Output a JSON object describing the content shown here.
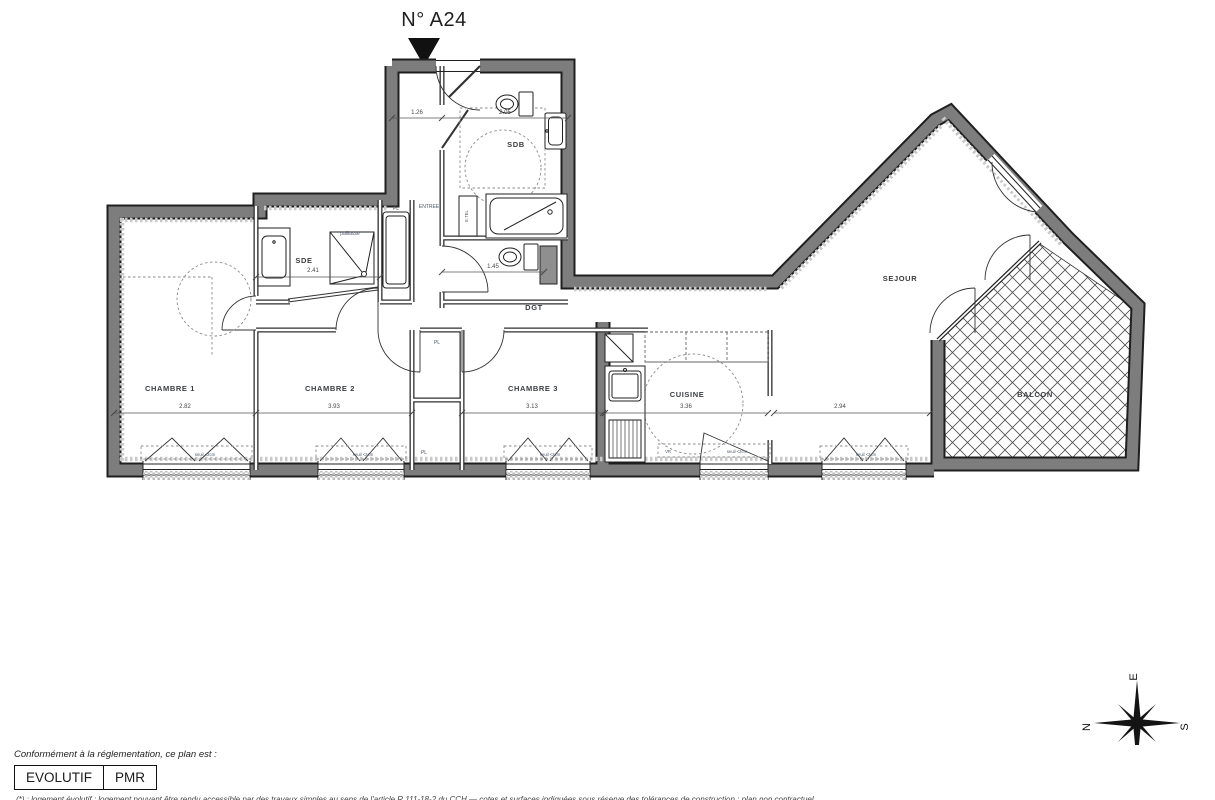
{
  "title": "N° A24",
  "plan": {
    "rooms": {
      "entree": "ENTREE",
      "sdb": "SDB",
      "sde": "SDE",
      "dgt": "DGT",
      "ch1": "CHAMBRE 1",
      "ch2": "CHAMBRE 2",
      "ch3": "CHAMBRE 3",
      "cuisine": "CUISINE",
      "sejour": "SEJOUR",
      "balcon": "BALCON"
    },
    "closets": {
      "pl1": "PL",
      "pl2": "PL",
      "pl3": "PL"
    },
    "annotations": {
      "paillasse": "paillasse",
      "etel": "E.TEL",
      "vr": "VR",
      "seuil": "seuil <2cm"
    },
    "dims": {
      "entree": "1.26",
      "sdb": "2.05",
      "sde": "2.41",
      "wc": "1.45",
      "ch1": "2.82",
      "ch2": "3.93",
      "ch3": "3.13",
      "cuisine": "3.36",
      "sejour": "2.94"
    },
    "colors": {
      "wall": "#7d7d7d",
      "outline": "#1f1f1f",
      "hatch": "#c9c9c9"
    }
  },
  "legend": {
    "caption": "Conformément à la réglementation, ce plan est :",
    "evolutif": "EVOLUTIF",
    "pmr": "PMR"
  },
  "compass": {
    "north": "N",
    "east": "E",
    "south": "S",
    "west": "O"
  },
  "footnote": "(*) : logement évolutif : logement pouvant être rendu accessible par des travaux simples au sens de l'article R.111-18-2 du CCH — cotes et surfaces indiquées sous réserve des tolérances de construction ; plan non contractuel."
}
